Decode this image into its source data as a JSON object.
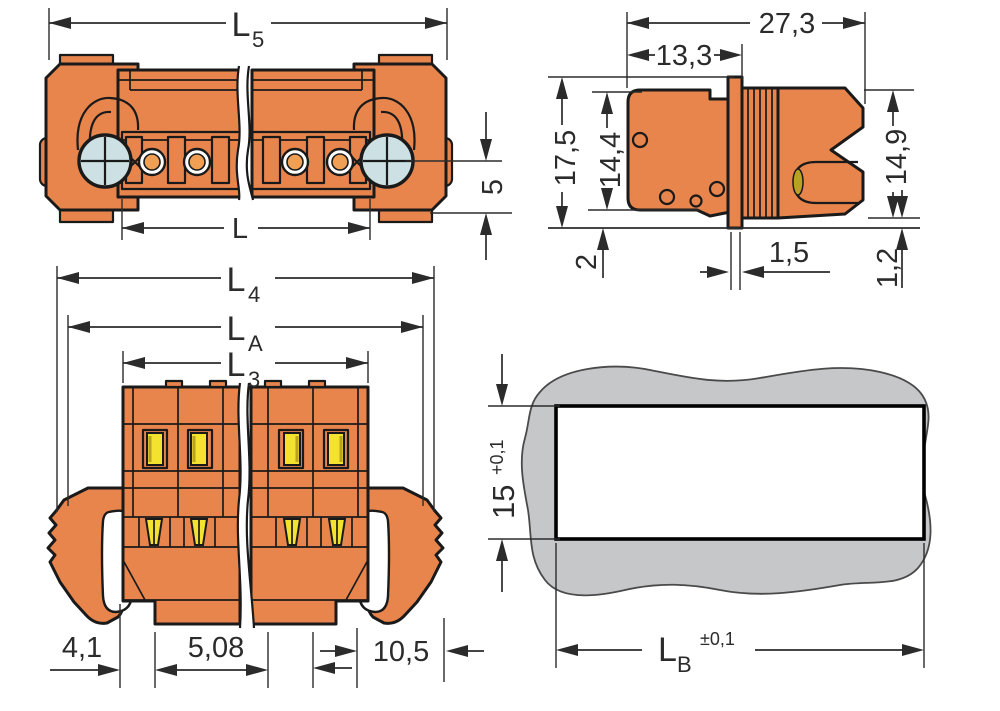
{
  "dims": {
    "l5": {
      "base": "L",
      "sub": "5"
    },
    "l": {
      "base": "L"
    },
    "h5": {
      "base": "5"
    },
    "d27_3": {
      "base": "27,3"
    },
    "d13_3": {
      "base": "13,3"
    },
    "d17_5": {
      "base": "17,5"
    },
    "d14_4": {
      "base": "14,4"
    },
    "d14_9": {
      "base": "14,9"
    },
    "d2": {
      "base": "2"
    },
    "d1_5": {
      "base": "1,5"
    },
    "d1_2": {
      "base": "1,2"
    },
    "l4": {
      "base": "L",
      "sub": "4"
    },
    "la": {
      "base": "L",
      "sub": "A"
    },
    "l3": {
      "base": "L",
      "sub": "3"
    },
    "d4_1": {
      "base": "4,1"
    },
    "d5_08": {
      "base": "5,08"
    },
    "d10_5": {
      "base": "10,5"
    },
    "d15": {
      "base": "15",
      "tol": "+0,1"
    },
    "lb": {
      "base": "L",
      "sub": "B",
      "tol": "±0,1"
    }
  },
  "colors": {
    "orange": "#e8854d",
    "contact": "#f0a055",
    "screw": "#cde0e3",
    "yellow": "#f3e32f",
    "yellow_dark": "#b9a21f",
    "panel": "#c6c7c9",
    "outline": "#1a1a1a",
    "dim": "#2b2b2b",
    "ink": "#2b2b2b",
    "paper": "#ffffff"
  }
}
